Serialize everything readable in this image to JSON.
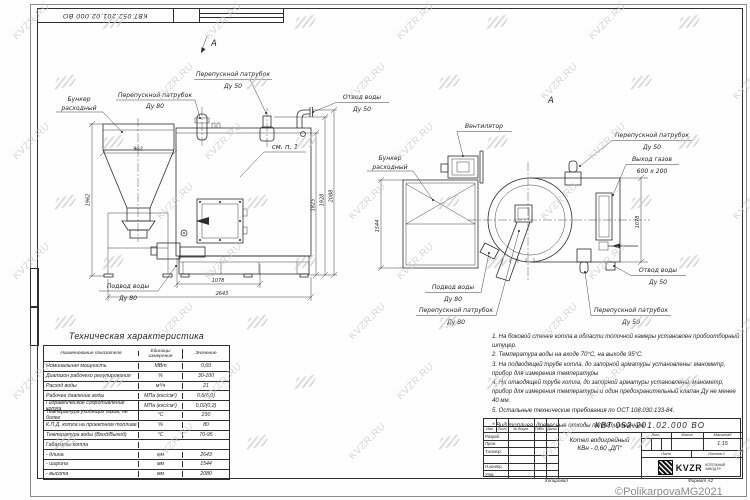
{
  "sheet": {
    "corner_stamp": "КВТ.052.201.02.000 ВО",
    "copyright": "©PolikarpovaMG2021",
    "watermark_text": "KVZR.RU"
  },
  "front_view": {
    "view_marker": "А",
    "labels": {
      "bunker1": "Бункер",
      "bunker2": "расходный",
      "bypass80_1": "Перепускной патрубок",
      "bypass80_2": "Ду 80",
      "bypass50_1": "Перепускной патрубок",
      "bypass50_2": "Ду 50",
      "outlet1": "Отвод воды",
      "outlet2": "Ду 50",
      "see_note": "см. п. 1",
      "inlet1": "Подвод воды",
      "inlet2": "Ду 80"
    },
    "dims": {
      "bunker_width": "902",
      "bunker_height": "1962",
      "h1": "1825",
      "h2": "1928",
      "h3": "2088",
      "l1": "1078",
      "l2": "2643"
    }
  },
  "side_view": {
    "view_marker": "А",
    "labels": {
      "fan": "Вентилятор",
      "bunker1": "Бункер",
      "bunker2": "расходный",
      "bypass50_top1": "Перепускной патрубок",
      "bypass50_top2": "Ду 50",
      "gas1": "Выход газов",
      "gas2": "600 х 200",
      "outlet1": "Отвод воды",
      "outlet2": "Ду 50",
      "bypass50_bot1": "Перепускной патрубок",
      "bypass50_bot2": "Ду 50",
      "bypass80_1": "Перепускной патрубок",
      "bypass80_2": "Ду 80",
      "inlet1": "Подвод воды",
      "inlet2": "Ду 80"
    },
    "dims": {
      "width": "1544",
      "h_right": "1078"
    }
  },
  "spec_table": {
    "title": "Техническая характеристика",
    "col1": "Наименование показателя",
    "col2a": "Единицы",
    "col2b": "измерения",
    "col3": "Значение",
    "rows": [
      [
        "Номинальная мощность",
        "МВт",
        "0,60"
      ],
      [
        "Диапазон рабочего регулирования",
        "%",
        "30-100"
      ],
      [
        "Расход воды",
        "м³/ч",
        "21"
      ],
      [
        "Рабочее давление воды",
        "МПа (кгс/см²)",
        "0,6(6,0)"
      ],
      [
        "Гидравлическое сопротивление котла",
        "МПа (кгс/см²)",
        "0,02(0,2)"
      ],
      [
        "Температура уходящих газов, не более",
        "°С",
        "230"
      ],
      [
        "К.П.Д. котла на проектном топливе",
        "%",
        "80"
      ],
      [
        "Температура воды (Вход/Выход)",
        "°С",
        "70-95"
      ],
      [
        "Габариты котла",
        "",
        ""
      ],
      [
        "  - длина",
        "мм",
        "2643"
      ],
      [
        "  - ширина",
        "мм",
        "1544"
      ],
      [
        "  - высота",
        "мм",
        "2080"
      ]
    ]
  },
  "notes": {
    "items": [
      "1. На боковой стенке котла в области топочной камеры установлен пробоотборный штуцер.",
      "2. Температура воды на входе  70°С, на выходе  95°С.",
      "3. На подводящей трубе котла, до запорной арматуры установлены: манометр, прибор для измерения температуры",
      "4. На отводящей трубе котла, до запорной арматуры установлены: манометр, прибор для измерения температуры и один предохранительный клапан Ду не менее 40 мм.",
      "5. Остальные технические требования по ОСТ 108.030.133-84."
    ],
    "fuel": "* Вид топлива:  древесные отходы пеллетированные."
  },
  "title_block": {
    "doc_number": "КВТ.052.201.02.000 ВО",
    "product1": "Котел водогрейный",
    "product2": "КВн - 0,60  „ДП“",
    "h_izm": "Изм.",
    "h_list": "Лист",
    "h_doc": "№ докум.",
    "h_sign": "Подп.",
    "h_date": "Дата",
    "roles": [
      "Разраб.",
      "Пров.",
      "Т.контр.",
      "",
      "Н.контр.",
      "Утв."
    ],
    "h_lit": "Лит.",
    "h_mass": "Масса",
    "h_scale": "Масштаб",
    "scale": "1:15",
    "sheet": "Лист",
    "sheets": "Листов 1",
    "logo": "KVZR",
    "company1": "КОТЕЛЬНЫЙ",
    "company2": "ЗАВОД.РУ",
    "copied": "Копировал",
    "format": "Формат А2"
  }
}
